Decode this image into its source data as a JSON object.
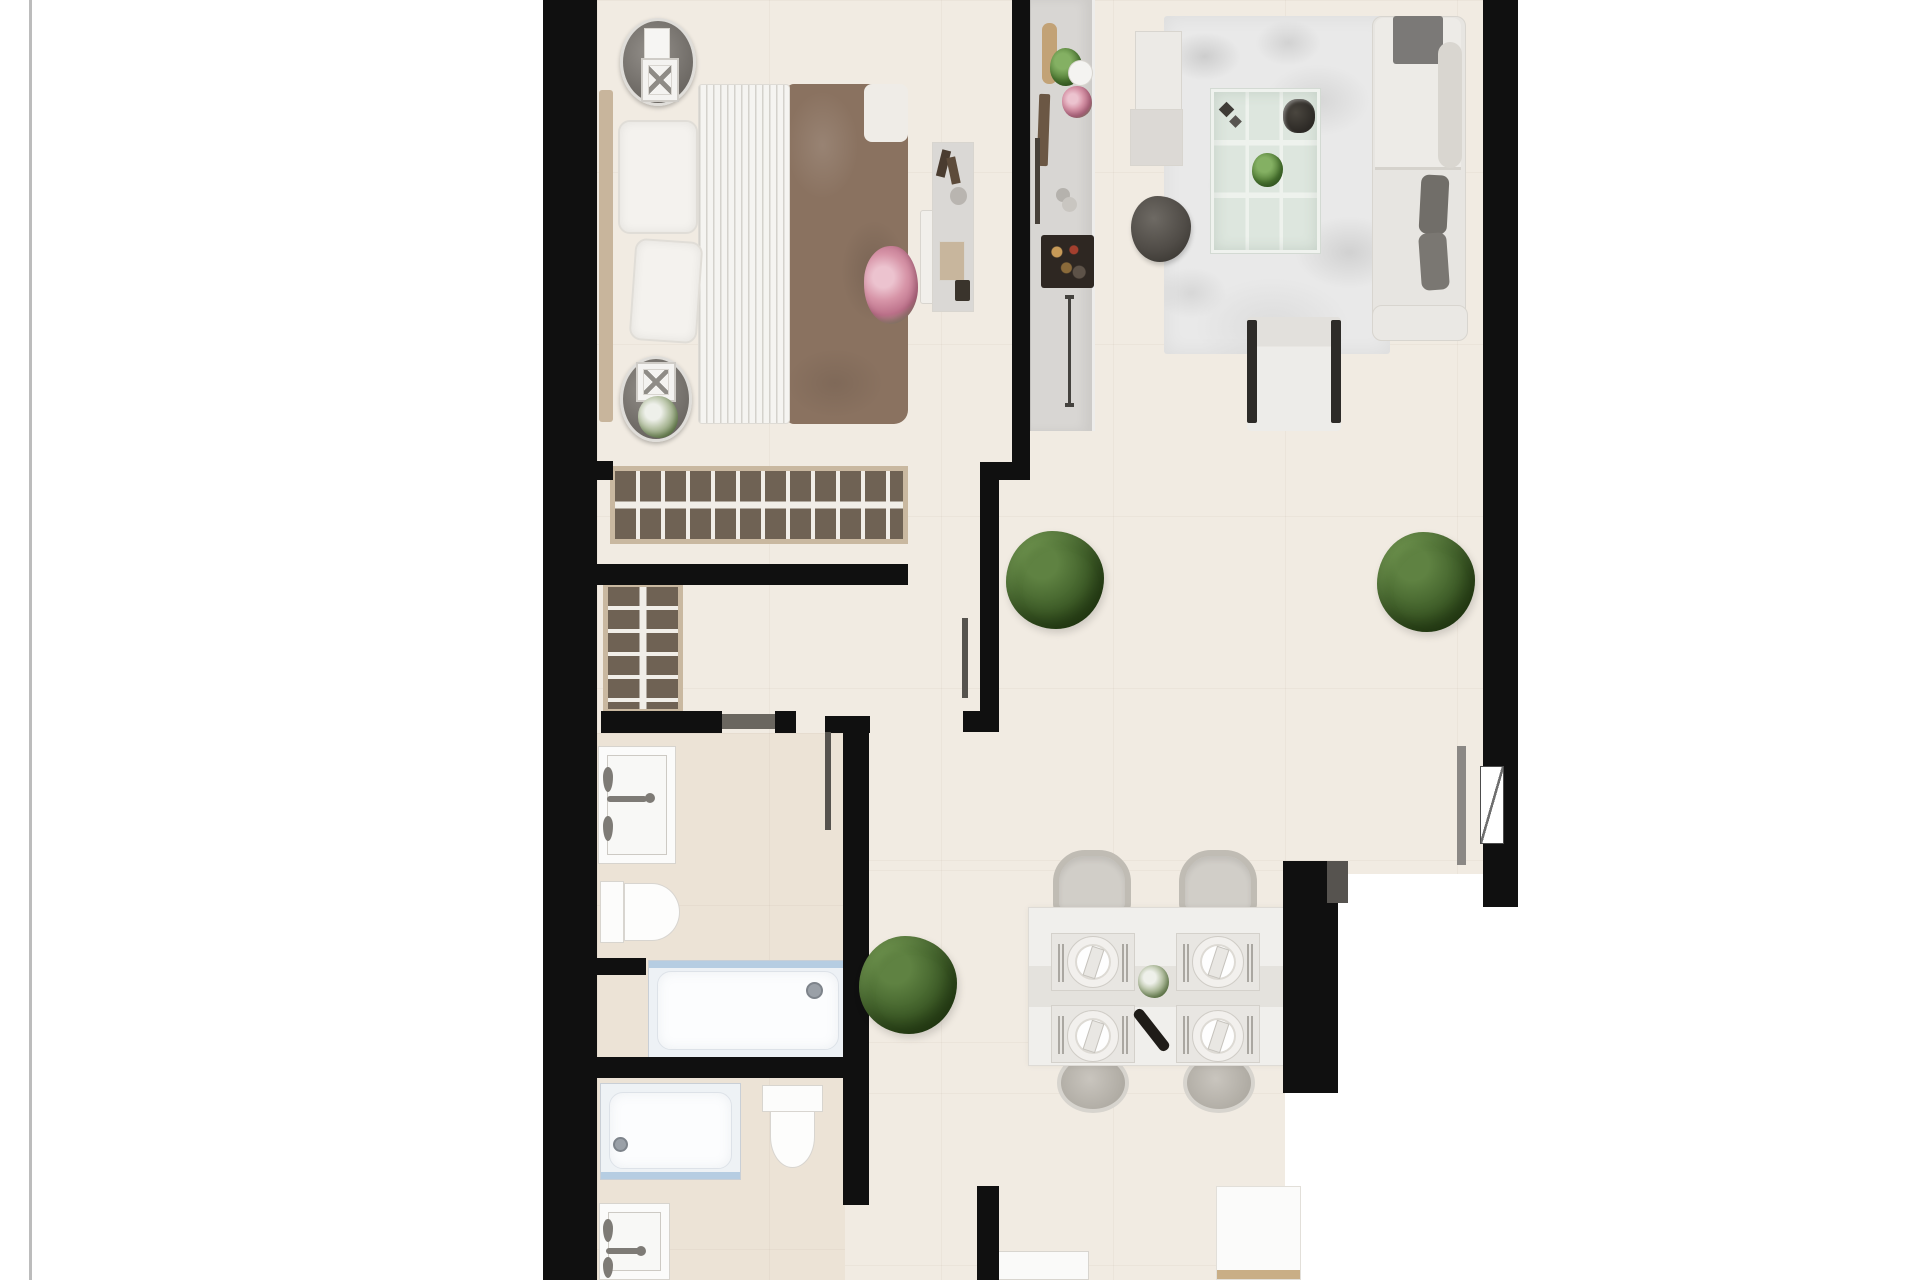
{
  "meta": {
    "title": "apartment-floor-plan-top-view",
    "canvas_width": 1920,
    "canvas_height": 1280
  },
  "palette": {
    "wall": "#101010",
    "wall_gray": "#5c5955",
    "floor": "#f1ebe2",
    "floor_warm": "#ece3d6",
    "outside": "#ffffff",
    "wood_tan": "#c9b8a0",
    "wardrobe_brown": "#6f6254",
    "blanket_brown": "#8a7260",
    "tub_blue_edge": "#b6cde2",
    "plant_green": "#47672f"
  },
  "elements": [
    {
      "name": "page-border-line",
      "kind": "rect",
      "x": 29,
      "y": 0,
      "w": 3,
      "h": 1280,
      "color": "#bcbcbc"
    },
    {
      "name": "floor-main",
      "kind": "floor",
      "x": 597,
      "y": 0,
      "w": 886,
      "h": 874
    },
    {
      "name": "floor-dining",
      "kind": "floor",
      "x": 597,
      "y": 870,
      "w": 741,
      "h": 223
    },
    {
      "name": "floor-bottom-corridor",
      "kind": "floor",
      "x": 597,
      "y": 1093,
      "w": 688,
      "h": 187
    },
    {
      "name": "floor-bathroom-zone",
      "kind": "floor-warm",
      "x": 597,
      "y": 733,
      "w": 248,
      "h": 547
    },
    {
      "name": "living-room-rug",
      "kind": "rug",
      "x": 1164,
      "y": 16,
      "w": 226,
      "h": 338
    },
    {
      "name": "bed-blanket",
      "kind": "blanket",
      "x": 786,
      "y": 84,
      "w": 122,
      "h": 340,
      "color": "#8a7260"
    },
    {
      "name": "bed-duvet",
      "kind": "duvet",
      "x": 698,
      "y": 84,
      "w": 92,
      "h": 340
    },
    {
      "name": "bed-headboard",
      "kind": "rect",
      "x": 599,
      "y": 90,
      "w": 14,
      "h": 332,
      "color": "#c8b59c",
      "r": "3px"
    },
    {
      "name": "bed-pillow-top",
      "kind": "pillow",
      "x": 618,
      "y": 120,
      "w": 80,
      "h": 114
    },
    {
      "name": "bed-pillow-bottom",
      "kind": "pillow",
      "x": 632,
      "y": 240,
      "w": 68,
      "h": 102,
      "rot": 4
    },
    {
      "name": "bed-fold-pillow",
      "kind": "rect",
      "x": 864,
      "y": 84,
      "w": 44,
      "h": 58,
      "color": "#efece7",
      "r": "8px"
    },
    {
      "name": "bed-flower-bouquet",
      "kind": "bouquet",
      "x": 864,
      "y": 246,
      "w": 54,
      "h": 78
    },
    {
      "name": "bed-end-bench",
      "kind": "panel",
      "x": 920,
      "y": 210,
      "w": 50,
      "h": 94,
      "color": "#f1efeb",
      "r": "3px"
    },
    {
      "name": "nightstand-top",
      "kind": "nightstand",
      "x": 620,
      "y": 18,
      "w": 76,
      "h": 88
    },
    {
      "name": "nightstand-top-book",
      "kind": "panel",
      "x": 644,
      "y": 28,
      "w": 26,
      "h": 34,
      "color": "#f6f5f3"
    },
    {
      "name": "nightstand-top-lamp",
      "kind": "lamp",
      "x": 641,
      "y": 58,
      "w": 38,
      "h": 44
    },
    {
      "name": "nightstand-bottom",
      "kind": "nightstand",
      "x": 620,
      "y": 356,
      "w": 72,
      "h": 86
    },
    {
      "name": "nightstand-bottom-lamp",
      "kind": "lamp",
      "x": 636,
      "y": 362,
      "w": 40,
      "h": 40
    },
    {
      "name": "nightstand-bottom-plant",
      "kind": "plant-white",
      "x": 638,
      "y": 396,
      "w": 40,
      "h": 42
    },
    {
      "name": "bedroom-dresser",
      "kind": "panel",
      "x": 932,
      "y": 142,
      "w": 42,
      "h": 170,
      "color": "#dad8d5"
    },
    {
      "name": "dresser-perfume-1",
      "kind": "rect",
      "x": 939,
      "y": 150,
      "w": 9,
      "h": 27,
      "color": "#4a3c30",
      "rot": 14
    },
    {
      "name": "dresser-perfume-2",
      "kind": "rect",
      "x": 949,
      "y": 157,
      "w": 9,
      "h": 27,
      "color": "#5d4b3a",
      "rot": -12
    },
    {
      "name": "dresser-mirror",
      "kind": "rect",
      "x": 950,
      "y": 187,
      "w": 17,
      "h": 18,
      "color": "#b9b5b0",
      "r": "50%"
    },
    {
      "name": "dresser-tray",
      "kind": "panel",
      "x": 939,
      "y": 241,
      "w": 26,
      "h": 40,
      "color": "#c8b69d"
    },
    {
      "name": "dresser-box",
      "kind": "rect",
      "x": 955,
      "y": 280,
      "w": 15,
      "h": 21,
      "color": "#3a342c",
      "r": "2px"
    },
    {
      "name": "wardrobe-long",
      "kind": "wardrobe-h",
      "x": 610,
      "y": 466,
      "w": 298,
      "h": 78
    },
    {
      "name": "wardrobe-tall",
      "kind": "wardrobe-v",
      "x": 603,
      "y": 582,
      "w": 80,
      "h": 132
    },
    {
      "name": "kitchen-counter",
      "kind": "counter",
      "x": 1030,
      "y": 0,
      "w": 65,
      "h": 431
    },
    {
      "name": "kitchen-cutting-board",
      "kind": "rect",
      "x": 1042,
      "y": 23,
      "w": 15,
      "h": 61,
      "color": "#c2a276",
      "r": "7px"
    },
    {
      "name": "kitchen-plant",
      "kind": "plant-mini",
      "x": 1050,
      "y": 48,
      "w": 32,
      "h": 38
    },
    {
      "name": "kitchen-bowl",
      "kind": "panel",
      "x": 1068,
      "y": 60,
      "w": 25,
      "h": 26,
      "color": "#f4f3f1",
      "r": "50%"
    },
    {
      "name": "kitchen-flowers",
      "kind": "bouquet",
      "x": 1062,
      "y": 86,
      "w": 30,
      "h": 32
    },
    {
      "name": "kitchen-knife-block",
      "kind": "rect",
      "x": 1038,
      "y": 94,
      "w": 11,
      "h": 72,
      "color": "#6b5744",
      "r": "2px",
      "rot": 2
    },
    {
      "name": "kitchen-utensil",
      "kind": "rect",
      "x": 1035,
      "y": 138,
      "w": 5,
      "h": 86,
      "color": "#474039"
    },
    {
      "name": "kitchen-cup-1",
      "kind": "rect",
      "x": 1056,
      "y": 188,
      "w": 14,
      "h": 14,
      "color": "#b5b2ad",
      "r": "50%"
    },
    {
      "name": "kitchen-cup-2",
      "kind": "rect",
      "x": 1062,
      "y": 197,
      "w": 15,
      "h": 15,
      "color": "#c9c6c1",
      "r": "50%"
    },
    {
      "name": "kitchen-dark-tray",
      "kind": "tray-dark",
      "x": 1041,
      "y": 235,
      "w": 53,
      "h": 53
    },
    {
      "name": "kitchen-cabinet-handle",
      "kind": "i-handle",
      "x": 1065,
      "y": 295,
      "w": 9,
      "h": 112
    },
    {
      "name": "living-sideboard",
      "kind": "panel",
      "x": 1135,
      "y": 31,
      "w": 47,
      "h": 87,
      "color": "#eceae6"
    },
    {
      "name": "living-side-table",
      "kind": "panel",
      "x": 1130,
      "y": 109,
      "w": 53,
      "h": 57,
      "color": "#dcd9d5"
    },
    {
      "name": "living-pouf",
      "kind": "pouf",
      "x": 1131,
      "y": 196,
      "w": 60,
      "h": 66
    },
    {
      "name": "glass-coffee-table",
      "kind": "glass-table",
      "x": 1211,
      "y": 89,
      "w": 109,
      "h": 164
    },
    {
      "name": "coffee-table-deco",
      "kind": "deco-diamonds",
      "x": 1218,
      "y": 100,
      "w": 29,
      "h": 34
    },
    {
      "name": "coffee-table-bowl",
      "kind": "bowl-dark",
      "x": 1283,
      "y": 99,
      "w": 32,
      "h": 34
    },
    {
      "name": "coffee-table-plant",
      "kind": "plant-mini",
      "x": 1252,
      "y": 153,
      "w": 31,
      "h": 34
    },
    {
      "name": "sofa-base",
      "kind": "panel",
      "x": 1372,
      "y": 16,
      "w": 94,
      "h": 325,
      "color": "#e7e5e1",
      "r": "10px"
    },
    {
      "name": "sofa-chaise",
      "kind": "chaise",
      "x": 1375,
      "y": 18,
      "w": 86,
      "h": 152
    },
    {
      "name": "sofa-blanket",
      "kind": "rect",
      "x": 1393,
      "y": 16,
      "w": 50,
      "h": 48,
      "color": "#7b7977",
      "r": "3px"
    },
    {
      "name": "sofa-back-cushion",
      "kind": "rect",
      "x": 1438,
      "y": 42,
      "w": 24,
      "h": 126,
      "color": "#d9d6d0",
      "r": "12px"
    },
    {
      "name": "sofa-pillow-1",
      "kind": "rect",
      "x": 1420,
      "y": 175,
      "w": 28,
      "h": 59,
      "color": "#716e69",
      "r": "8px",
      "rot": 3
    },
    {
      "name": "sofa-pillow-2",
      "kind": "rect",
      "x": 1420,
      "y": 233,
      "w": 28,
      "h": 57,
      "color": "#7a7772",
      "r": "8px",
      "rot": -4
    },
    {
      "name": "sofa-armrest",
      "kind": "panel",
      "x": 1372,
      "y": 305,
      "w": 96,
      "h": 36,
      "color": "#eae8e4",
      "r": "10px"
    },
    {
      "name": "armchair",
      "kind": "armchair",
      "x": 1247,
      "y": 317,
      "w": 94,
      "h": 114
    },
    {
      "name": "dining-chair-top-left",
      "kind": "chair",
      "x": 1053,
      "y": 850,
      "w": 78,
      "h": 64
    },
    {
      "name": "dining-chair-top-right",
      "kind": "chair",
      "x": 1179,
      "y": 850,
      "w": 78,
      "h": 64
    },
    {
      "name": "dining-chair-seat-bottom-left",
      "kind": "chair-seat",
      "x": 1057,
      "y": 1053,
      "w": 72,
      "h": 60
    },
    {
      "name": "dining-chair-seat-bottom-right",
      "kind": "chair-seat",
      "x": 1183,
      "y": 1053,
      "w": 72,
      "h": 60
    },
    {
      "name": "dining-table",
      "kind": "dining-table",
      "x": 1028,
      "y": 907,
      "w": 258,
      "h": 159
    },
    {
      "name": "placemat-top-left",
      "kind": "placemat",
      "x": 1051,
      "y": 933,
      "w": 84,
      "h": 58
    },
    {
      "name": "placemat-top-right",
      "kind": "placemat",
      "x": 1176,
      "y": 933,
      "w": 84,
      "h": 58
    },
    {
      "name": "placemat-bottom-left",
      "kind": "placemat",
      "x": 1051,
      "y": 1005,
      "w": 84,
      "h": 58
    },
    {
      "name": "placemat-bottom-right",
      "kind": "placemat",
      "x": 1176,
      "y": 1005,
      "w": 84,
      "h": 58
    },
    {
      "name": "plate-top-left",
      "kind": "plate",
      "x": 1067,
      "y": 936,
      "w": 52,
      "h": 52
    },
    {
      "name": "plate-top-right",
      "kind": "plate",
      "x": 1192,
      "y": 936,
      "w": 52,
      "h": 52
    },
    {
      "name": "plate-bottom-left",
      "kind": "plate",
      "x": 1067,
      "y": 1010,
      "w": 52,
      "h": 52
    },
    {
      "name": "plate-bottom-right",
      "kind": "plate",
      "x": 1192,
      "y": 1010,
      "w": 52,
      "h": 52
    },
    {
      "name": "table-centerpiece",
      "kind": "plant-white",
      "x": 1138,
      "y": 965,
      "w": 31,
      "h": 33
    },
    {
      "name": "wine-bottle",
      "kind": "rect",
      "x": 1146,
      "y": 1005,
      "w": 11,
      "h": 50,
      "color": "#1f1c18",
      "r": "5px",
      "rot": -38
    },
    {
      "name": "bathroom1-vanity",
      "kind": "vanity",
      "x": 598,
      "y": 746,
      "w": 78,
      "h": 118
    },
    {
      "name": "bathroom1-faucet-knob-1",
      "kind": "knob",
      "x": 603,
      "y": 767,
      "w": 10,
      "h": 25
    },
    {
      "name": "bathroom1-faucet-knob-2",
      "kind": "knob",
      "x": 603,
      "y": 816,
      "w": 10,
      "h": 25
    },
    {
      "name": "bathroom1-faucet-spout",
      "kind": "rect",
      "x": 607,
      "y": 796,
      "w": 40,
      "h": 6,
      "color": "#7e7b76",
      "r": "3px"
    },
    {
      "name": "bathroom1-faucet-dot",
      "kind": "rect",
      "x": 645,
      "y": 793,
      "w": 10,
      "h": 10,
      "color": "#7e7b76",
      "r": "50%"
    },
    {
      "name": "bathroom1-toilet-tank",
      "kind": "panel",
      "x": 600,
      "y": 881,
      "w": 24,
      "h": 62,
      "color": "#fcfcfb"
    },
    {
      "name": "bathroom1-toilet-bowl",
      "kind": "toilet-bowl-r",
      "x": 624,
      "y": 883,
      "w": 56,
      "h": 58
    },
    {
      "name": "bathroom1-bathtub",
      "kind": "tub",
      "x": 648,
      "y": 960,
      "w": 200,
      "h": 99
    },
    {
      "name": "bathtub-drain",
      "kind": "drain",
      "x": 806,
      "y": 982,
      "w": 17,
      "h": 17
    },
    {
      "name": "bathroom2-shower-tray",
      "kind": "tub2",
      "x": 600,
      "y": 1083,
      "w": 141,
      "h": 97
    },
    {
      "name": "shower-tray-drain",
      "kind": "drain",
      "x": 613,
      "y": 1137,
      "w": 15,
      "h": 15
    },
    {
      "name": "bathroom2-toilet-tank",
      "kind": "panel",
      "x": 762,
      "y": 1085,
      "w": 61,
      "h": 27,
      "color": "#fcfcfb"
    },
    {
      "name": "bathroom2-toilet-bowl",
      "kind": "toilet-bowl-d",
      "x": 770,
      "y": 1111,
      "w": 45,
      "h": 57
    },
    {
      "name": "bathroom2-vanity",
      "kind": "vanity",
      "x": 599,
      "y": 1203,
      "w": 71,
      "h": 77
    },
    {
      "name": "bathroom2-faucet-knob-1",
      "kind": "knob",
      "x": 603,
      "y": 1219,
      "w": 10,
      "h": 23
    },
    {
      "name": "bathroom2-faucet-knob-2",
      "kind": "knob",
      "x": 603,
      "y": 1257,
      "w": 10,
      "h": 21
    },
    {
      "name": "bathroom2-faucet-spout",
      "kind": "rect",
      "x": 606,
      "y": 1248,
      "w": 39,
      "h": 6,
      "color": "#7e7b76",
      "r": "3px"
    },
    {
      "name": "bathroom2-faucet-dot",
      "kind": "rect",
      "x": 636,
      "y": 1246,
      "w": 10,
      "h": 10,
      "color": "#7e7b76",
      "r": "50%"
    },
    {
      "name": "bottom-center-cabinet",
      "kind": "panel",
      "x": 996,
      "y": 1251,
      "w": 93,
      "h": 29,
      "color": "#fafaf9"
    },
    {
      "name": "bottom-right-cabinet",
      "kind": "box-tan",
      "x": 1216,
      "y": 1186,
      "w": 85,
      "h": 94
    },
    {
      "name": "wall-exterior-left",
      "kind": "wall",
      "x": 543,
      "y": 0,
      "w": 54,
      "h": 1280
    },
    {
      "name": "wall-exterior-right",
      "kind": "wall",
      "x": 1483,
      "y": 0,
      "w": 35,
      "h": 907
    },
    {
      "name": "window-right",
      "kind": "window",
      "x": 1480,
      "y": 766,
      "w": 24,
      "h": 78
    },
    {
      "name": "wall-bedroom-divider",
      "kind": "wall",
      "x": 1012,
      "y": 0,
      "w": 18,
      "h": 480
    },
    {
      "name": "wall-divider-jog",
      "kind": "wall",
      "x": 980,
      "y": 462,
      "w": 50,
      "h": 18
    },
    {
      "name": "wall-hall-upper",
      "kind": "wall",
      "x": 980,
      "y": 478,
      "w": 19,
      "h": 254
    },
    {
      "name": "wall-hall-foot",
      "kind": "wall",
      "x": 963,
      "y": 711,
      "w": 36,
      "h": 21
    },
    {
      "name": "wall-bedroom-stub",
      "kind": "wall",
      "x": 587,
      "y": 461,
      "w": 26,
      "h": 19
    },
    {
      "name": "wall-dressing-top",
      "kind": "wall",
      "x": 597,
      "y": 564,
      "w": 311,
      "h": 21
    },
    {
      "name": "wall-bath-top-a",
      "kind": "wall",
      "x": 601,
      "y": 711,
      "w": 121,
      "h": 22
    },
    {
      "name": "wall-bath-top-b",
      "kind": "rect",
      "x": 722,
      "y": 714,
      "w": 53,
      "h": 15,
      "color": "#6a665f"
    },
    {
      "name": "wall-bath-top-c",
      "kind": "wall",
      "x": 775,
      "y": 711,
      "w": 21,
      "h": 22
    },
    {
      "name": "wall-bath-top-corner",
      "kind": "wall",
      "x": 825,
      "y": 716,
      "w": 45,
      "h": 17
    },
    {
      "name": "wall-corridor",
      "kind": "wall",
      "x": 843,
      "y": 716,
      "w": 26,
      "h": 489
    },
    {
      "name": "wall-bathroom-divider",
      "kind": "wall",
      "x": 597,
      "y": 1057,
      "w": 263,
      "h": 21
    },
    {
      "name": "wall-toilet-stub",
      "kind": "wall",
      "x": 597,
      "y": 958,
      "w": 49,
      "h": 17
    },
    {
      "name": "wall-bottom-stub",
      "kind": "wall",
      "x": 977,
      "y": 1186,
      "w": 22,
      "h": 94
    },
    {
      "name": "wall-dining-right",
      "kind": "wall",
      "x": 1283,
      "y": 861,
      "w": 55,
      "h": 232
    },
    {
      "name": "wall-dining-cap",
      "kind": "rect",
      "x": 1327,
      "y": 861,
      "w": 21,
      "h": 42,
      "color": "#56534f"
    },
    {
      "name": "door-leaf-bedroom",
      "kind": "rect",
      "x": 962,
      "y": 618,
      "w": 6,
      "h": 80,
      "color": "#56534e"
    },
    {
      "name": "door-leaf-bathroom",
      "kind": "rect",
      "x": 825,
      "y": 732,
      "w": 6,
      "h": 98,
      "color": "#56534e"
    },
    {
      "name": "window-jamb-line",
      "kind": "rect",
      "x": 1457,
      "y": 746,
      "w": 9,
      "h": 119,
      "color": "#8b8885"
    },
    {
      "name": "plant-living-room",
      "kind": "plant-big",
      "x": 1377,
      "y": 532,
      "w": 98,
      "h": 100
    },
    {
      "name": "plant-hallway",
      "kind": "plant-big",
      "x": 1006,
      "y": 531,
      "w": 98,
      "h": 98
    },
    {
      "name": "plant-bath-corridor",
      "kind": "plant-big",
      "x": 859,
      "y": 936,
      "w": 98,
      "h": 98
    }
  ]
}
